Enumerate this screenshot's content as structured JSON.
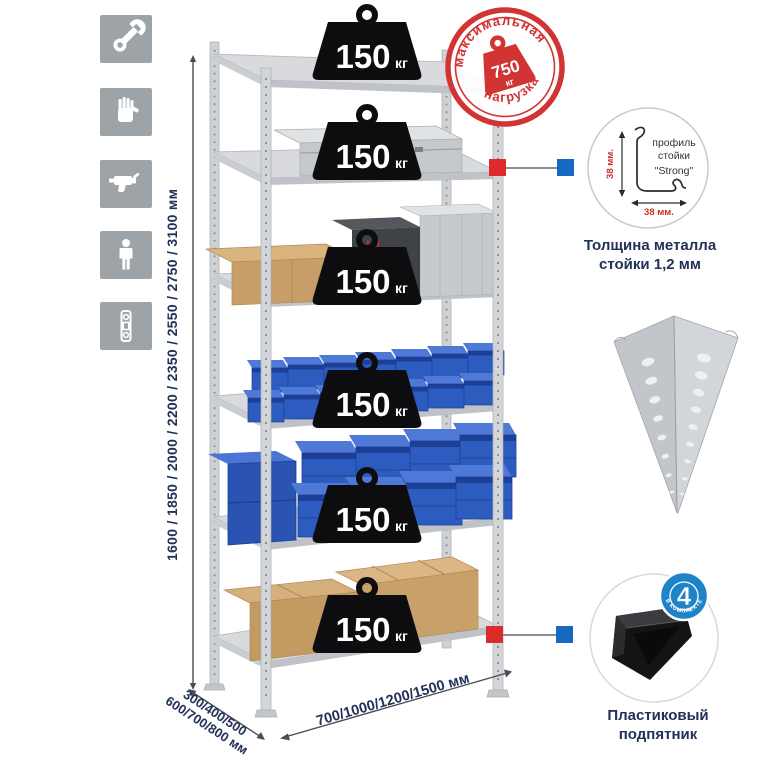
{
  "sidebar_icons": {
    "items": [
      {
        "name": "wrench-icon"
      },
      {
        "name": "gloves-icon"
      },
      {
        "name": "drill-icon"
      },
      {
        "name": "person-icon"
      },
      {
        "name": "level-icon"
      }
    ]
  },
  "dimensions": {
    "height": "1600 / 1850 / 2000 / 2200 / 2350 / 2550 / 2750 / 3100 мм",
    "depth_line1": "300/400/500",
    "depth_line2": "600/700/800 мм",
    "width": "700/1000/1200/1500 мм"
  },
  "shelf_badges": {
    "items": [
      {
        "value": "150",
        "unit": "кг"
      },
      {
        "value": "150",
        "unit": "кг"
      },
      {
        "value": "150",
        "unit": "кг"
      },
      {
        "value": "150",
        "unit": "кг"
      },
      {
        "value": "150",
        "unit": "кг"
      },
      {
        "value": "150",
        "unit": "кг"
      }
    ]
  },
  "stamp": {
    "arc_top": "максимальная",
    "arc_bottom": "нагрузка",
    "value": "750",
    "unit": "кг"
  },
  "profile": {
    "line1": "профиль",
    "line2": "стойки",
    "line3": "\"Strong\"",
    "dim_vertical": "38 мм.",
    "dim_horizontal": "38 мм.",
    "caption1": "Толщина металла",
    "caption2": "стойки 1,2 мм"
  },
  "foot": {
    "badge_value": "4",
    "badge_sub": "штуки",
    "badge_arc": "в комплекте",
    "caption1": "Пластиковый",
    "caption2": "подпятник"
  },
  "colors": {
    "navy_text": "#223158",
    "stamp_red": "#d23434",
    "marker_red": "#dd2a2a",
    "marker_blue": "#1668c0",
    "badge_blue": "#1f83c8",
    "bin_blue": "#2d5cc0",
    "icon_gray": "#9ea3a8"
  }
}
